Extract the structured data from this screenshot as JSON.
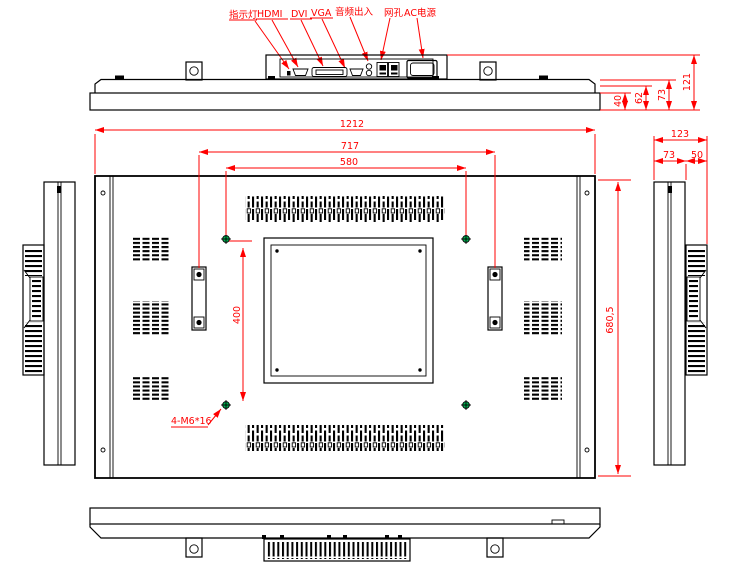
{
  "drawing": {
    "background": "#ffffff",
    "colors": {
      "outline": "#000000",
      "dimension": "#ff0000",
      "vesa_marker": "#00b050"
    },
    "port_labels": {
      "indicator": "指示灯",
      "hdmi": "HDMI",
      "dvi": "DVI",
      "vga": "VGA",
      "audio": "音频出入",
      "lan": "网孔",
      "power": "AC电源"
    },
    "top_view_dims": {
      "d40": "40",
      "d62": "62",
      "d73": "73",
      "d121": "121"
    },
    "rear_view_dims": {
      "width_total": "1212",
      "handle_span": "717",
      "vesa_width": "580",
      "vesa_height": "400",
      "height_total": "680,5",
      "screw_note": "4-M6*16"
    },
    "side_view_dims": {
      "depth_total": "123",
      "panel_depth": "73",
      "vent_depth": "50"
    }
  }
}
